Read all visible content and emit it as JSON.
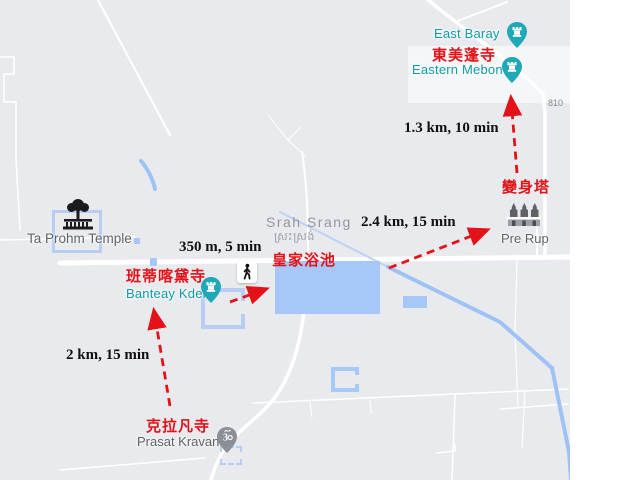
{
  "places": {
    "east_baray": {
      "name": "East Baray",
      "icon": "castle-pin"
    },
    "eastern_mebon": {
      "name": "Eastern Mebon",
      "name_zh": "東美蓬寺",
      "icon": "castle-pin"
    },
    "pre_rup": {
      "name": "Pre Rup",
      "name_zh": "變身塔",
      "icon": "temple-towers"
    },
    "srah_srang": {
      "name": "Srah Srang",
      "name_km": "ស្រះស្រង់",
      "name_zh": "皇家浴池"
    },
    "banteay_kdei": {
      "name": "Banteay Kdei",
      "name_zh": "班蒂喀黛寺",
      "icon": "castle-pin"
    },
    "ta_prohm": {
      "name": "Ta Prohm Temple",
      "icon": "tree-temple"
    },
    "prasat_kravan": {
      "name": "Prasat Kravan",
      "name_zh": "克拉凡寺",
      "icon": "om-pin"
    }
  },
  "routes": [
    {
      "id": "kravan-to-banteay",
      "distance": "2 km, 15 min"
    },
    {
      "id": "banteay-to-srahsrang",
      "distance": "350 m, 5 min"
    },
    {
      "id": "srahsrang-to-prerup",
      "distance": "2.4 km, 15 min"
    },
    {
      "id": "prerup-to-mebon",
      "distance": "1.3 km, 10 min"
    }
  ],
  "road_labels": {
    "route_810": "810"
  },
  "icons": {
    "walking": "pedestrian",
    "pin_glyph": "castle-tower",
    "kravan_glyph": "om"
  },
  "colors": {
    "map_background": "#e8eaed",
    "water_blue": "#a6c7f8",
    "pin_teal": "#1fa9b8",
    "annotation_red": "#e31219",
    "distance_text": "#111111",
    "poi_teal_text": "#0d9aa8",
    "poi_gray_text": "#5f6368"
  }
}
